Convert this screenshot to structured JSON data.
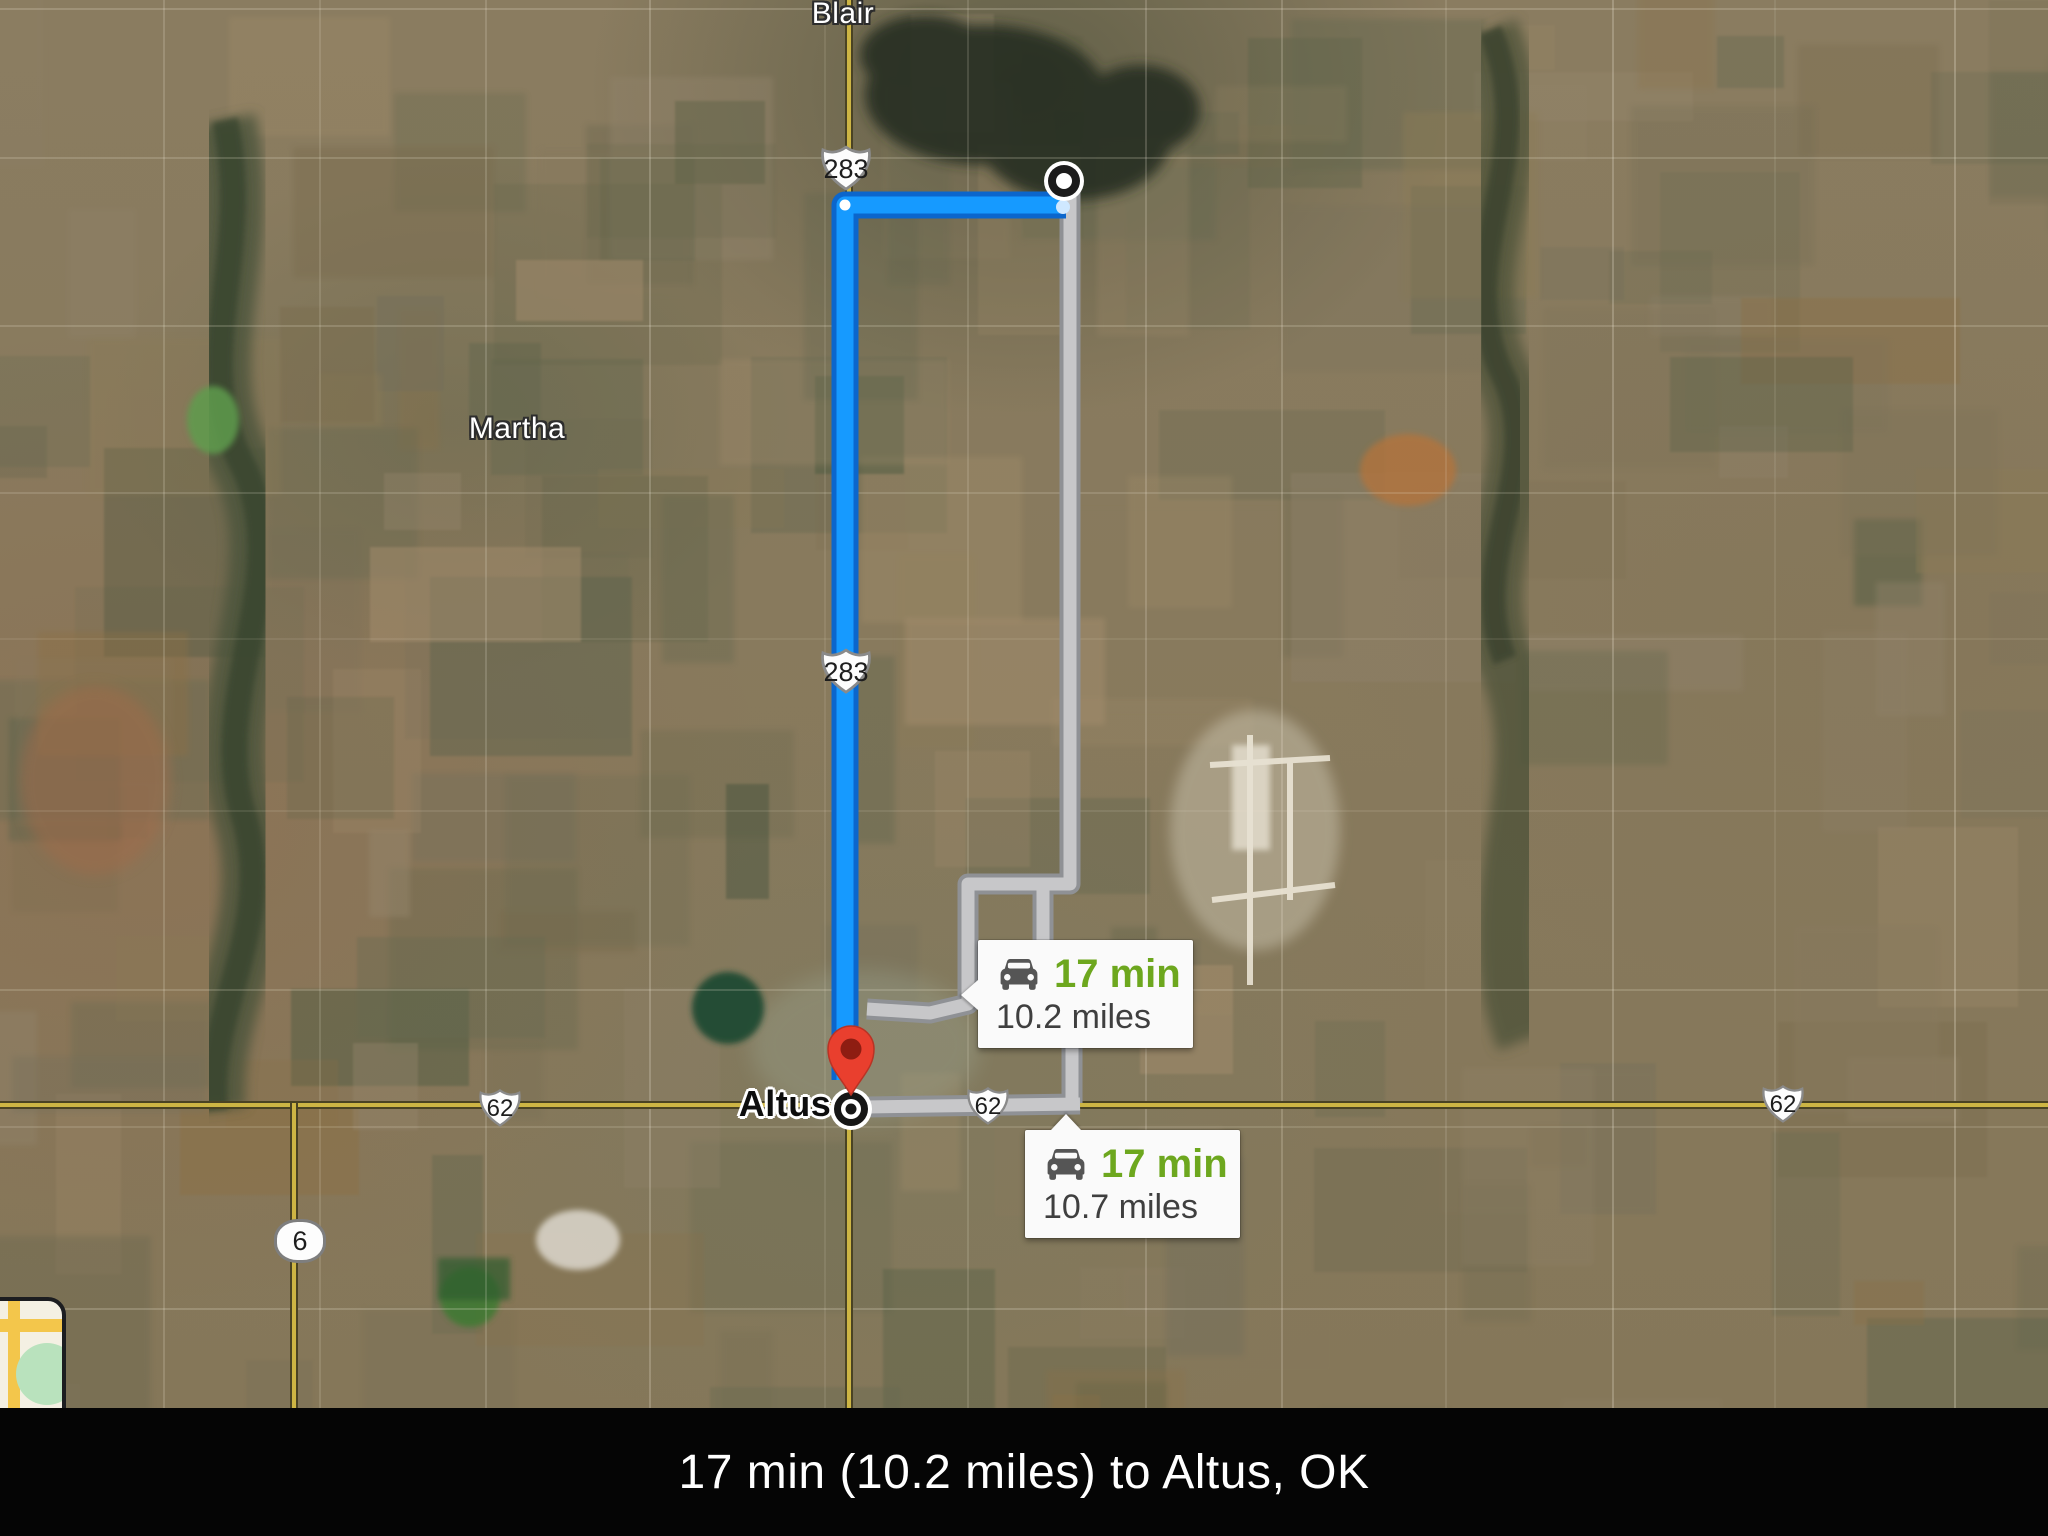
{
  "map": {
    "places": [
      {
        "name": "Blair"
      },
      {
        "name": "Martha"
      },
      {
        "name": "Altus"
      }
    ],
    "shields": [
      {
        "route": "US-283",
        "label": "283"
      },
      {
        "route": "US-283",
        "label": "283"
      },
      {
        "route": "US-62",
        "label": "62"
      },
      {
        "route": "US-62",
        "label": "62"
      },
      {
        "route": "US-62",
        "label": "62"
      },
      {
        "route": "OK-6",
        "label": "6"
      }
    ],
    "callouts": [
      {
        "duration": "17 min",
        "distance": "10.2 miles"
      },
      {
        "duration": "17 min",
        "distance": "10.7 miles"
      }
    ],
    "colors": {
      "selected_route": "#169aff",
      "selected_route_casing": "#0b66cc",
      "alternate_route": "#c7c7c9",
      "alternate_route_casing": "#8f9195",
      "duration_text": "#6da71e",
      "distance_text": "#3f3f3f",
      "pin": "#e93f2e",
      "highway": "#cdb544"
    }
  },
  "status_bar": {
    "text": "17 min (10.2 miles) to Altus, OK"
  }
}
